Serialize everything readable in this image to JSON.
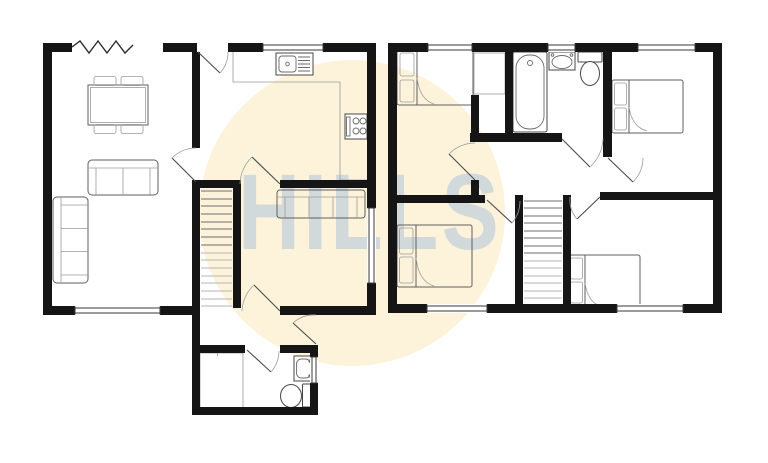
{
  "watermark": {
    "text": "HILLS",
    "circle_color": "#fcf3da",
    "text_color": "#b7c8da",
    "text_opacity": "0.6"
  },
  "colors": {
    "background": "#ffffff",
    "wall": "#151515",
    "furniture_line": "#5f5f5f",
    "fixture_fill": "#ffffff",
    "window_line": "#3a3a3a"
  }
}
